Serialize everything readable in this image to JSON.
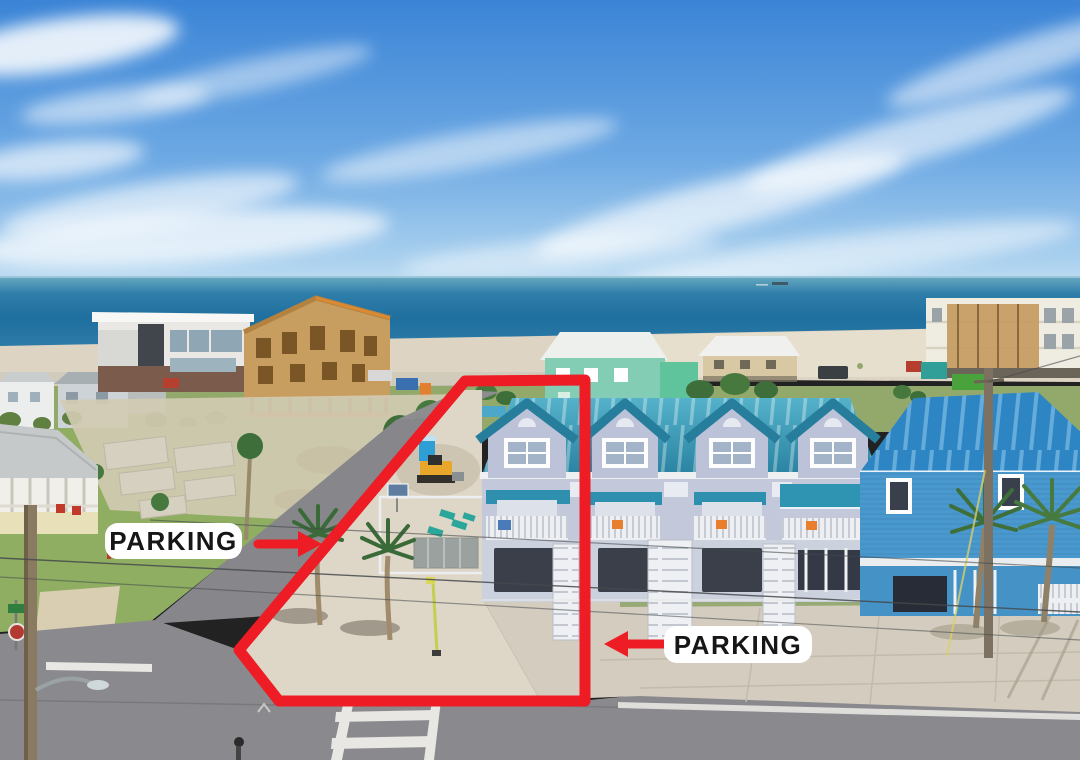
{
  "annotations": {
    "left_parking": {
      "text": "PARKING"
    },
    "right_parking": {
      "text": "PARKING"
    },
    "boundary_color": "#ee1c25",
    "label_background": "#ffffff",
    "label_text_color": "#161616"
  },
  "icons": {
    "left_arrow": "arrow-left-icon",
    "right_arrow": "arrow-right-icon",
    "boundary": "property-outline-polygon"
  },
  "palette": {
    "sky_top": "#3b84d6",
    "sky_horizon": "#bddcf2",
    "ocean_deep": "#1f6f9f",
    "ocean_light": "#5ea3bd",
    "sand": "#ddd4c3",
    "bright_sand": "#e9e1d0",
    "grass": "#8fac62",
    "asphalt": "#8a8a8e",
    "concrete": "#d4cdbf",
    "townhouse_roof_teal": "#2f8fae",
    "townhouse_wall": "#c3c9da",
    "blue_house_siding": "#4a99ce",
    "blue_house_roof": "#2e85c3",
    "seafoam_house": "#82cdb4",
    "construction_plywood": "#c79e5f",
    "palm_green": "#3e6e3a",
    "annotation_red": "#ee1c25"
  }
}
